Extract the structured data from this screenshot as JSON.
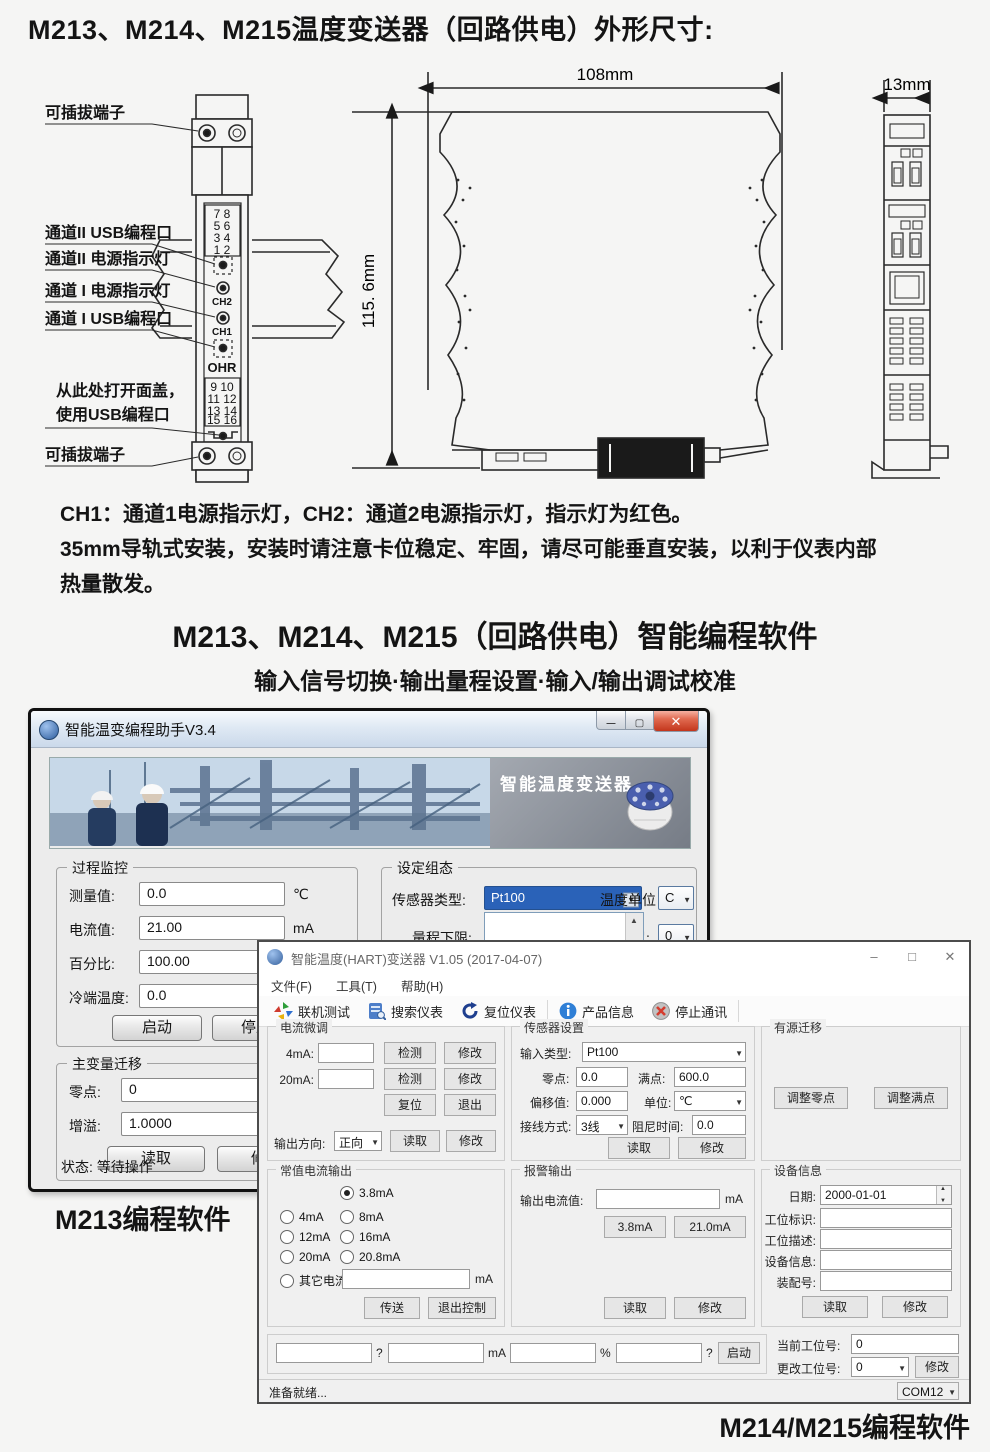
{
  "page": {
    "title": "M213、M214、M215温度变送器（回路供电）外形尺寸:",
    "notes": [
      "CH1：通道1电源指示灯，CH2：通道2电源指示灯，指示灯为红色。",
      "35mm导轨式安装，安装时请注意卡位稳定、牢固，请尽可能垂直安装，以利于仪表内部",
      "热量散发。"
    ],
    "heading": "M213、M214、M215（回路供电）智能编程软件",
    "subheading": "输入信号切换·输出量程设置·输入/输出调试校准",
    "caption_left": "M213编程软件",
    "caption_right": "M214/M215编程软件"
  },
  "diagram": {
    "callouts": {
      "plug_top": "可插拔端子",
      "ch2_usb": "通道II USB编程口",
      "ch2_led": "通道II 电源指示灯",
      "ch1_led": "通道 I 电源指示灯",
      "ch1_usb": "通道 I USB编程口",
      "open_cover1": "从此处打开面盖，",
      "open_cover2": "使用USB编程口",
      "plug_bottom": "可插拔端子"
    },
    "front": {
      "top_terminals": [
        "7  8",
        "5  6",
        "3  4",
        "1  2"
      ],
      "ch2": "CH2",
      "ch1": "CH1",
      "brand": "OHR",
      "bottom_terminals": [
        "9  10",
        "11 12",
        "13 14",
        "15 16"
      ]
    },
    "dims": {
      "width": "108mm",
      "height": "115. 6mm",
      "side_width": "13mm"
    }
  },
  "win1": {
    "title": "智能温变编程助手V3.4",
    "banner_label": "智能温度变送器",
    "monitor": {
      "title": "过程监控",
      "rows": [
        {
          "label": "测量值:",
          "value": "0.0",
          "unit": "℃"
        },
        {
          "label": "电流值:",
          "value": "21.00",
          "unit": "mA"
        },
        {
          "label": "百分比:",
          "value": "100.00",
          "unit": "%"
        },
        {
          "label": "冷端温度:",
          "value": "0.0",
          "unit": ""
        }
      ],
      "start_btn": "启动",
      "stop_btn": "停止"
    },
    "config": {
      "title": "设定组态",
      "sensor_label": "传感器类型:",
      "sensor_value": "Pt100",
      "unit_label": "温度单位",
      "unit_value": "C",
      "range_low_label": "量程下限:",
      "damping_label": "阻尼:",
      "damping_value": "0",
      "dropdown_items": [
        "Cu50",
        "Pt100"
      ]
    },
    "pv_shift": {
      "title": "主变量迁移",
      "zero_label": "零点:",
      "zero_value": "0",
      "gain_label": "增溢:",
      "gain_value": "1.0000",
      "read_btn": "读取",
      "modify_btn": "修改"
    },
    "status": "状态: 等待操作"
  },
  "win2": {
    "title": "智能温度(HART)变送器 V1.05 (2017-04-07)",
    "menus": [
      "文件(F)",
      "工具(T)",
      "帮助(H)"
    ],
    "toolbar": [
      "联机测试",
      "搜索仪表",
      "复位仪表",
      "产品信息",
      "停止通讯"
    ],
    "trim": {
      "title": "电流微调",
      "row4_label": "4mA:",
      "row20_label": "20mA:",
      "detect_btn": "检测",
      "modify_btn": "修改",
      "reset_btn": "复位",
      "exit_btn": "退出",
      "dir_label": "输出方向:",
      "dir_value": "正向",
      "read_btn": "读取"
    },
    "const_current": {
      "title": "常值电流输出",
      "opt_38": "3.8mA",
      "opt_4": "4mA",
      "opt_8": "8mA",
      "opt_12": "12mA",
      "opt_16": "16mA",
      "opt_20": "20mA",
      "opt_208": "20.8mA",
      "other_label": "其它电流",
      "other_unit": "mA",
      "send_btn": "传送",
      "exit_btn": "退出控制"
    },
    "sensor": {
      "title": "传感器设置",
      "type_label": "输入类型:",
      "type_value": "Pt100",
      "zero_label": "零点:",
      "zero_value": "0.0",
      "full_label": "满点:",
      "full_value": "600.0",
      "offset_label": "偏移值:",
      "offset_value": "0.000",
      "unit_label": "单位:",
      "unit_value": "℃",
      "wiring_label": "接线方式:",
      "wiring_value": "3线",
      "damping_label": "阻尼时间:",
      "damping_value": "0.0",
      "read_btn": "读取",
      "modify_btn": "修改"
    },
    "alarm": {
      "title": "报警输出",
      "out_label": "输出电流值:",
      "out_unit": "mA",
      "low_btn": "3.8mA",
      "high_btn": "21.0mA",
      "read_btn": "读取",
      "modify_btn": "修改"
    },
    "active_shift": {
      "title": "有源迁移",
      "zero_btn": "调整零点",
      "full_btn": "调整满点"
    },
    "device": {
      "title": "设备信息",
      "date_label": "日期:",
      "date_value": "2000-01-01",
      "tag_label": "工位标识:",
      "desc_label": "工位描述:",
      "info_label": "设备信息:",
      "assembly_label": "装配号:",
      "read_btn": "读取",
      "modify_btn": "修改"
    },
    "bottom": {
      "unit1": "?",
      "unit2": "mA",
      "unit3": "%",
      "unit4": "?",
      "start_btn": "启动",
      "current_station_label": "当前工位号:",
      "current_station_value": "0",
      "change_station_label": "更改工位号:",
      "change_station_value": "0",
      "modify_btn": "修改"
    },
    "statusbar": {
      "text": "准备就绪...",
      "port": "COM12"
    }
  }
}
